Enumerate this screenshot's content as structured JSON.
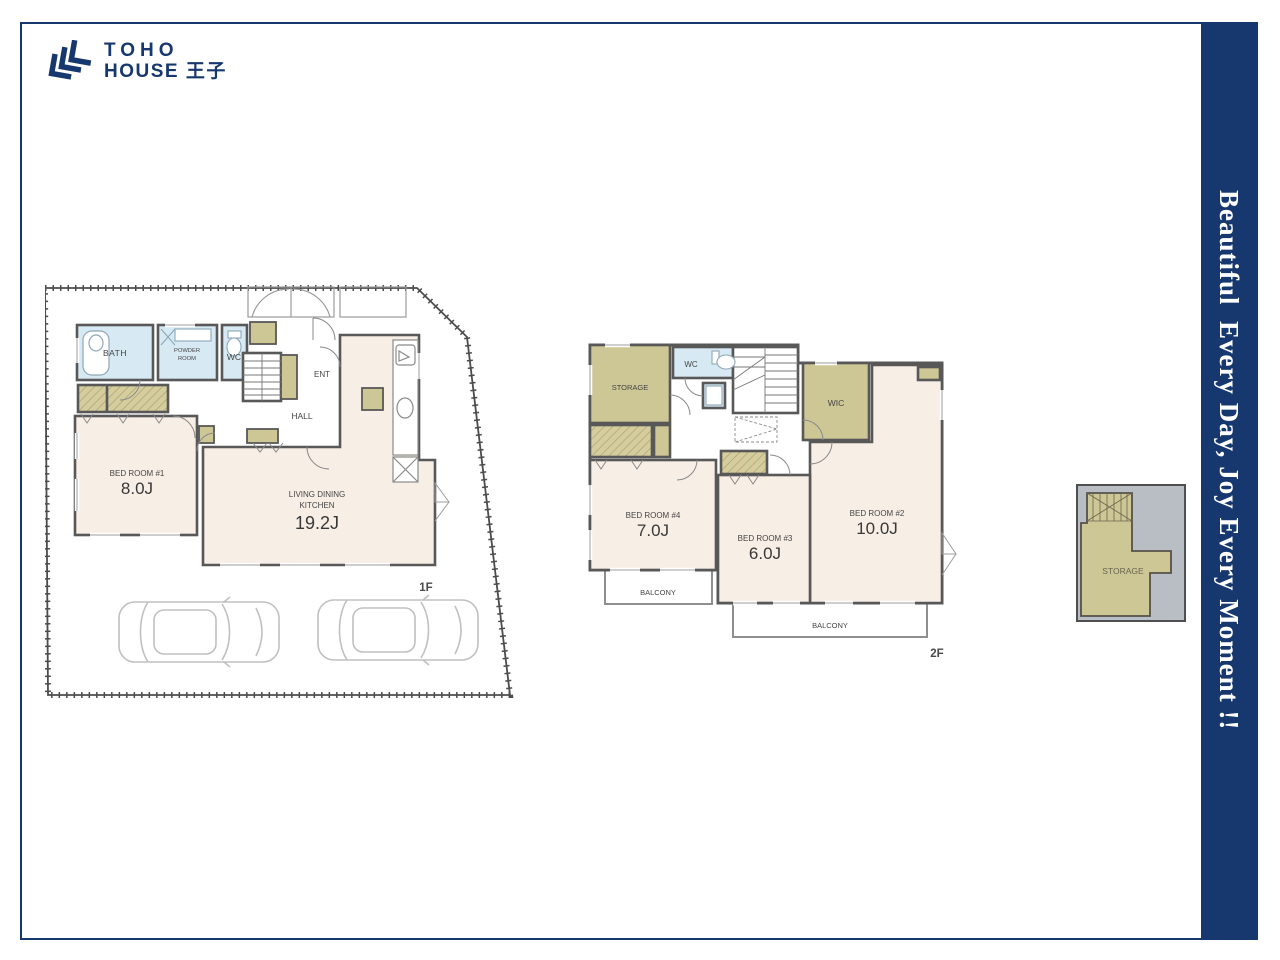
{
  "brand": {
    "line1": "TOHO",
    "line2": "HOUSE 王子"
  },
  "banner": {
    "text": "Beautiful  Every Day, Joy Every Moment !!"
  },
  "f1": {
    "label": "1F",
    "bath": "BATH",
    "powder1": "POWDER",
    "powder2": "ROOM",
    "wc": "WC",
    "ent": "ENT",
    "hall": "HALL",
    "br1": "BED ROOM #1",
    "br1a": "8.0J",
    "ldk1": "LIVING DINING",
    "ldk2": "KITCHEN",
    "ldka": "19.2J"
  },
  "f2": {
    "label": "2F",
    "storage": "STORAGE",
    "wc": "WC",
    "wic": "WIC",
    "br2": "BED ROOM #2",
    "br2a": "10.0J",
    "br3": "BED ROOM #3",
    "br3a": "6.0J",
    "br4": "BED ROOM #4",
    "br4a": "7.0J",
    "balL": "BALCONY",
    "balB": "BALCONY"
  },
  "attic": {
    "storage": "STORAGE"
  },
  "colors": {
    "navy": "#16386e",
    "wall": "#585858",
    "room_pink": "#f7eee5",
    "aqua": "#d7e9f3",
    "olive": "#cdc695",
    "site_line": "#4c4c4c",
    "attic_bg": "#b9bec5"
  }
}
